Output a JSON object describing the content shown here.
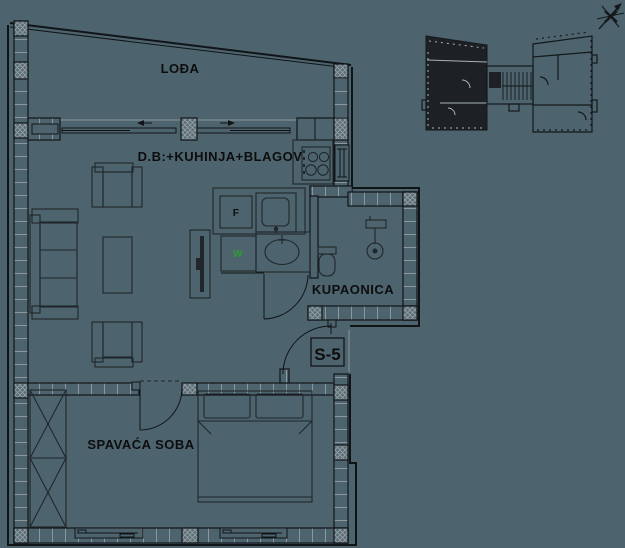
{
  "drawing": {
    "type": "apartment floor plan",
    "colors": {
      "background": "#4d646e",
      "line": "#111417",
      "light_line": "#8b979c",
      "dark_fill": "#1d2125",
      "accent_green": "#2f9a35",
      "text": "#0d0d0d"
    },
    "rooms": {
      "loggia": "LOĐA",
      "living_kitchen_dining": "D.B:+KUHINJA+BLAGOV",
      "bathroom": "KUPAONICA",
      "bedroom": "SPAVAĆA SOBA"
    },
    "unit_label": "S-5",
    "appliances": {
      "fridge": "F",
      "washing_machine": "W"
    }
  }
}
